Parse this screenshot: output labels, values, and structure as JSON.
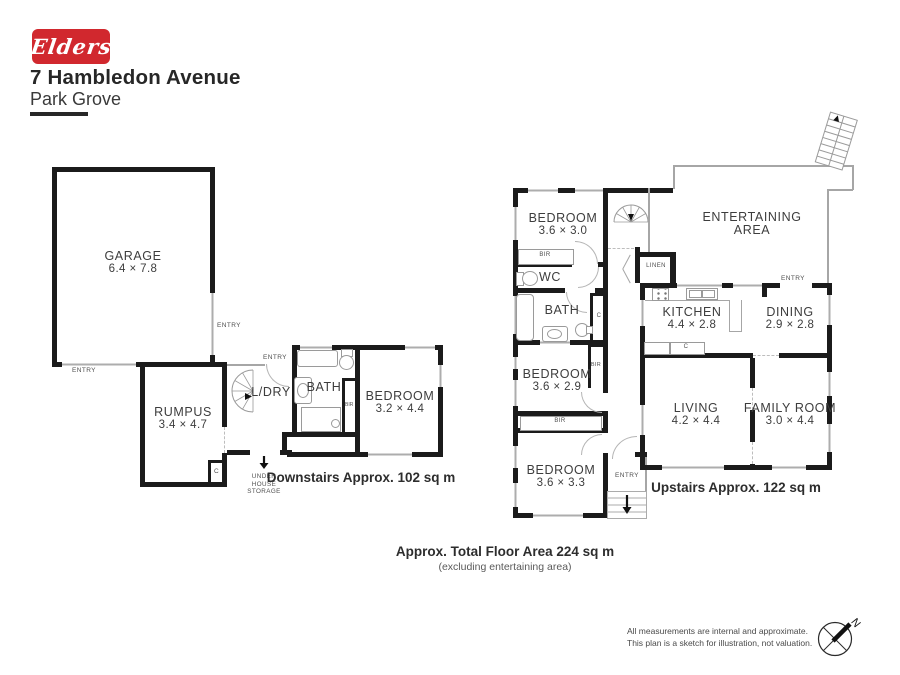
{
  "header": {
    "logo_text": "Elders",
    "title": "7 Hambledon Avenue",
    "subtitle": "Park Grove"
  },
  "labels": {
    "entry": "ENTRY",
    "bir": "BIR",
    "closet": "C",
    "wc": "WC",
    "bath": "BATH",
    "linen": "LINEN",
    "laundry": "L/DRY"
  },
  "downstairs": {
    "garage": {
      "name": "GARAGE",
      "dims": "6.4 × 7.8"
    },
    "rumpus": {
      "name": "RUMPUS",
      "dims": "3.4 × 4.7"
    },
    "bedroom": {
      "name": "BEDROOM",
      "dims": "3.2 × 4.4"
    },
    "storage": {
      "l1": "UNDER",
      "l2": "HOUSE",
      "l3": "STORAGE"
    },
    "caption": "Downstairs Approx. 102 sq m"
  },
  "upstairs": {
    "bedroom1": {
      "name": "BEDROOM",
      "dims": "3.6 × 3.0"
    },
    "bedroom2": {
      "name": "BEDROOM",
      "dims": "3.6 × 2.9"
    },
    "bedroom3": {
      "name": "BEDROOM",
      "dims": "3.6 × 3.3"
    },
    "kitchen": {
      "name": "KITCHEN",
      "dims": "4.4 × 2.8"
    },
    "dining": {
      "name": "DINING",
      "dims": "2.9 × 2.8"
    },
    "living": {
      "name": "LIVING",
      "dims": "4.2 × 4.4"
    },
    "family": {
      "name": "FAMILY ROOM",
      "dims": "3.0 × 4.4"
    },
    "entertaining": {
      "l1": "ENTERTAINING",
      "l2": "AREA"
    },
    "caption": "Upstairs Approx. 122 sq m"
  },
  "footer": {
    "total": "Approx. Total Floor Area 224 sq m",
    "total_note": "(excluding entertaining area)",
    "disclaimer1": "All measurements are internal and approximate.",
    "disclaimer2": "This plan is a sketch for illustration, not valuation.",
    "compass_n": "N"
  },
  "colors": {
    "brand_red": "#d1282e",
    "wall": "#1b1b1b",
    "thin_line": "#a6a6a6"
  }
}
